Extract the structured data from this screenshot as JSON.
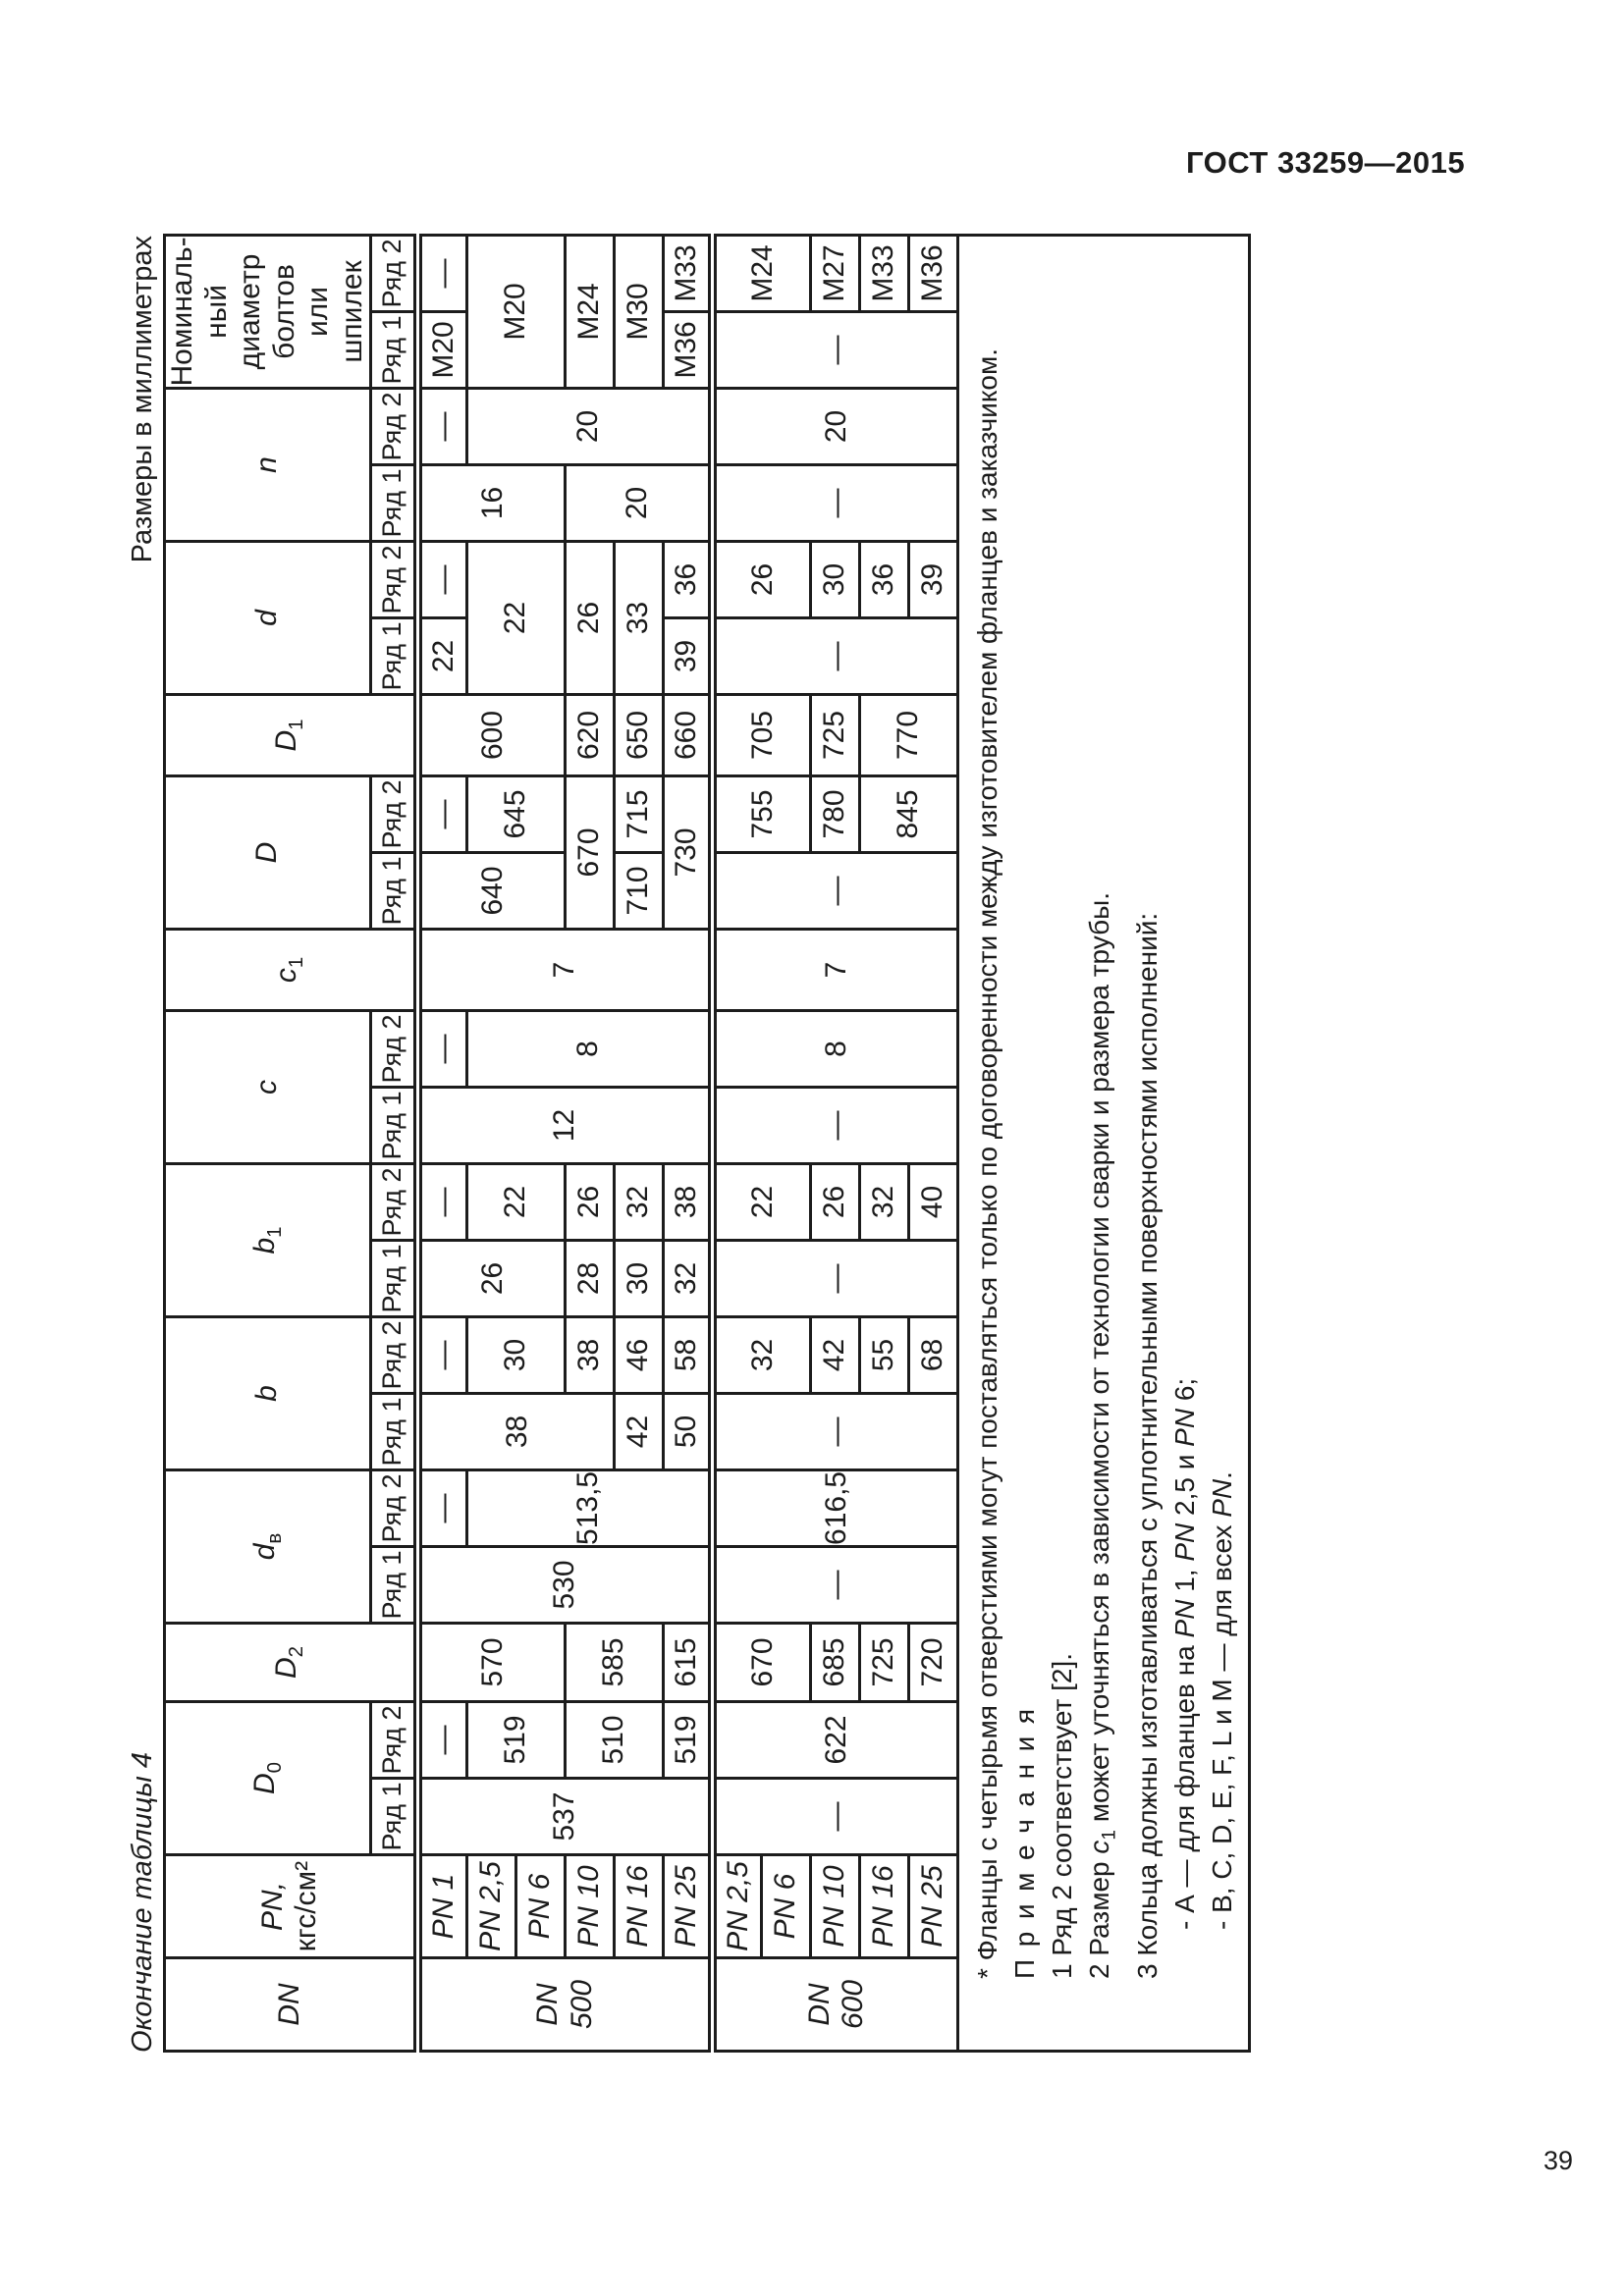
{
  "page": {
    "header": "ГОСТ 33259—2015",
    "number": "39"
  },
  "captions": {
    "left": "Окончание таблицы 4",
    "right": "Размеры в миллиметрах"
  },
  "table": {
    "ryad1": "Ряд 1",
    "ryad2": "Ряд 2",
    "head": {
      "dn": "DN",
      "pn_line1": "PN,",
      "pn_line2": "кгс/см²",
      "d0_m": "D",
      "d0_s": "0",
      "d2_m": "D",
      "d2_s": "2",
      "dv_m": "d",
      "dv_s": "в",
      "b": "b",
      "b1_m": "b",
      "b1_s": "1",
      "c": "c",
      "c1_m": "c",
      "c1_s": "1",
      "D": "D",
      "D1_m": "D",
      "D1_s": "1",
      "d": "d",
      "n": "n",
      "bolts": [
        "Номиналь-",
        "ный диаметр",
        "болтов",
        "или шпилек"
      ]
    },
    "rows": [
      [
        {
          "lines": [
            "DN",
            "500"
          ],
          "it": 1,
          "rs": 6,
          "lbl": 1
        },
        {
          "t": "PN 1",
          "it": 1,
          "lbl": 1
        },
        {
          "t": "537",
          "rs": 6
        },
        {
          "t": "—"
        },
        {
          "t": "570",
          "rs": 3
        },
        {
          "t": "530",
          "rs": 6
        },
        {
          "t": "—"
        },
        {
          "t": "38",
          "rs": 4
        },
        {
          "t": "—"
        },
        {
          "t": "26",
          "rs": 3
        },
        {
          "t": "—"
        },
        {
          "t": "12",
          "rs": 6
        },
        {
          "t": "—"
        },
        {
          "t": "7",
          "rs": 6
        },
        {
          "t": "640",
          "rs": 3
        },
        {
          "t": "—"
        },
        {
          "t": "600",
          "rs": 3
        },
        {
          "t": "22"
        },
        {
          "t": "—"
        },
        {
          "t": "16",
          "rs": 3
        },
        {
          "t": "—"
        },
        {
          "t": "М20"
        },
        {
          "t": "—"
        }
      ],
      [
        {
          "t": "PN 2,5",
          "it": 1,
          "lbl": 1
        },
        {
          "t": "519",
          "rs": 2
        },
        {
          "t": "513,5",
          "rs": 5
        },
        {
          "t": "30",
          "rs": 2
        },
        {
          "t": "22",
          "rs": 2
        },
        {
          "t": "8",
          "rs": 5
        },
        {
          "t": "645",
          "rs": 2
        },
        {
          "t": "22",
          "cs": 2,
          "rs": 2
        },
        {
          "t": "20",
          "rs": 5
        },
        {
          "t": "М20",
          "cs": 2,
          "rs": 2
        }
      ],
      [
        {
          "t": "PN 6",
          "it": 1,
          "lbl": 1
        }
      ],
      [
        {
          "t": "PN 10",
          "it": 1,
          "lbl": 1
        },
        {
          "t": "510",
          "rs": 2
        },
        {
          "t": "585",
          "rs": 2
        },
        {
          "t": "38"
        },
        {
          "t": "28"
        },
        {
          "t": "26"
        },
        {
          "t": "670",
          "cs": 2
        },
        {
          "t": "620"
        },
        {
          "t": "26",
          "cs": 2
        },
        {
          "t": "20",
          "rs": 3
        },
        {
          "t": "М24",
          "cs": 2
        }
      ],
      [
        {
          "t": "PN 16",
          "it": 1,
          "lbl": 1
        },
        {
          "t": "42"
        },
        {
          "t": "46"
        },
        {
          "t": "30"
        },
        {
          "t": "32"
        },
        {
          "t": "710"
        },
        {
          "t": "715"
        },
        {
          "t": "650"
        },
        {
          "t": "33",
          "cs": 2
        },
        {
          "t": "М30",
          "cs": 2
        }
      ],
      [
        {
          "t": "PN 25",
          "it": 1,
          "lbl": 1
        },
        {
          "t": "519"
        },
        {
          "t": "615"
        },
        {
          "t": "50"
        },
        {
          "t": "58"
        },
        {
          "t": "32"
        },
        {
          "t": "38"
        },
        {
          "t": "730",
          "cs": 2
        },
        {
          "t": "660"
        },
        {
          "t": "39"
        },
        {
          "t": "36"
        },
        {
          "t": "М36"
        },
        {
          "t": "М33"
        }
      ],
      [
        {
          "lines": [
            "DN",
            "600"
          ],
          "it": 1,
          "rs": 5,
          "lbl": 1
        },
        {
          "t": "PN 2,5",
          "it": 1,
          "lbl": 1
        },
        {
          "t": "—",
          "rs": 5
        },
        {
          "t": "622",
          "rs": 5
        },
        {
          "t": "670",
          "rs": 2
        },
        {
          "t": "—",
          "rs": 5
        },
        {
          "t": "616,5",
          "rs": 5
        },
        {
          "t": "—",
          "rs": 5
        },
        {
          "t": "32",
          "rs": 2
        },
        {
          "t": "—",
          "rs": 5
        },
        {
          "t": "22",
          "rs": 2
        },
        {
          "t": "—",
          "rs": 5
        },
        {
          "t": "8",
          "rs": 5
        },
        {
          "t": "7",
          "rs": 5
        },
        {
          "t": "—",
          "rs": 5
        },
        {
          "t": "755",
          "rs": 2
        },
        {
          "t": "705",
          "rs": 2
        },
        {
          "t": "—",
          "rs": 5
        },
        {
          "t": "26",
          "rs": 2
        },
        {
          "t": "—",
          "rs": 5
        },
        {
          "t": "20",
          "rs": 5
        },
        {
          "t": "—",
          "rs": 5
        },
        {
          "t": "М24",
          "rs": 2
        }
      ],
      [
        {
          "t": "PN 6",
          "it": 1,
          "lbl": 1
        }
      ],
      [
        {
          "t": "PN 10",
          "it": 1,
          "lbl": 1
        },
        {
          "t": "685"
        },
        {
          "t": "42"
        },
        {
          "t": "26"
        },
        {
          "t": "780"
        },
        {
          "t": "725"
        },
        {
          "t": "30"
        },
        {
          "t": "М27"
        }
      ],
      [
        {
          "t": "PN 16",
          "it": 1,
          "lbl": 1
        },
        {
          "t": "725"
        },
        {
          "t": "55"
        },
        {
          "t": "32"
        },
        {
          "t": "845",
          "rs": 2
        },
        {
          "t": "770",
          "rs": 2
        },
        {
          "t": "36"
        },
        {
          "t": "М33"
        }
      ],
      [
        {
          "t": "PN 25",
          "it": 1,
          "lbl": 1
        },
        {
          "t": "720"
        },
        {
          "t": "68"
        },
        {
          "t": "40"
        },
        {
          "t": "39"
        },
        {
          "t": "М36"
        }
      ]
    ],
    "footer_lines": [
      {
        "cls": "ind1",
        "parts": [
          {
            "t": "* Фланцы с четырьмя отверстиями могут поставляться только по договоренности между изготовителем фланцев и заказчиком."
          }
        ]
      },
      {
        "cls": "ind1 spaced",
        "parts": [
          {
            "t": "Примечания"
          }
        ]
      },
      {
        "cls": "ind1",
        "parts": [
          {
            "t": "1 Ряд 2 соответствует [2]."
          }
        ]
      },
      {
        "cls": "ind1",
        "parts": [
          {
            "t": "2 Размер "
          },
          {
            "t": "c",
            "it": 1
          },
          {
            "t": "1",
            "sub": 1
          },
          {
            "t": " может уточняться в зависимости от технологии сварки и размера трубы."
          }
        ]
      },
      {
        "cls": "ind1",
        "parts": [
          {
            "t": "3 Кольца должны изготавливаться с уплотнительными поверхностями исполнений:"
          }
        ]
      },
      {
        "cls": "ind2",
        "parts": [
          {
            "t": "- А — для фланцев на "
          },
          {
            "t": "PN",
            "it": 1
          },
          {
            "t": " 1, "
          },
          {
            "t": "PN",
            "it": 1
          },
          {
            "t": " 2,5 и "
          },
          {
            "t": "PN",
            "it": 1
          },
          {
            "t": " 6;"
          }
        ]
      },
      {
        "cls": "ind2",
        "parts": [
          {
            "t": "- В, C, D, E, F, L и М — для всех "
          },
          {
            "t": "PN",
            "it": 1
          },
          {
            "t": "."
          }
        ]
      }
    ]
  }
}
